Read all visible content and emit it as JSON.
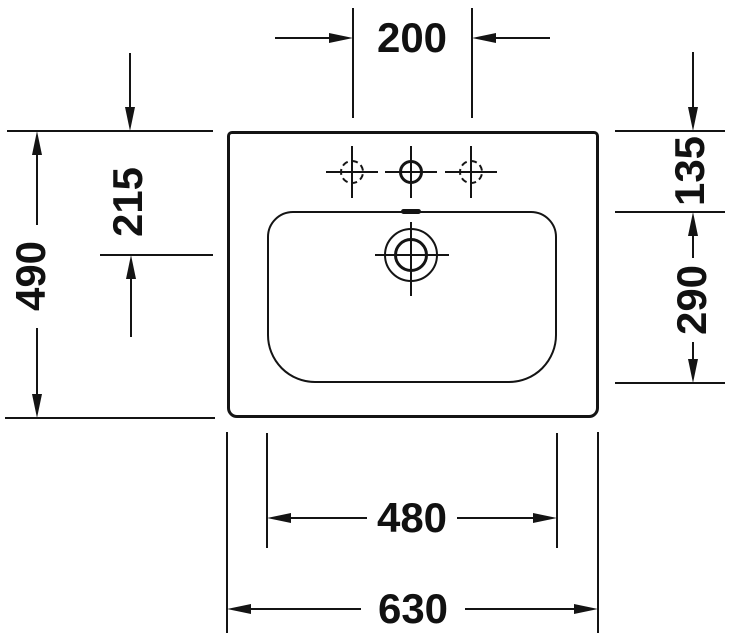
{
  "dimensions": {
    "faucet_hole_spacing": "200",
    "overall_depth": "490",
    "edge_to_drain_center": "215",
    "edge_to_bowl": "135",
    "bowl_depth": "290",
    "bowl_width": "480",
    "overall_width": "630"
  }
}
